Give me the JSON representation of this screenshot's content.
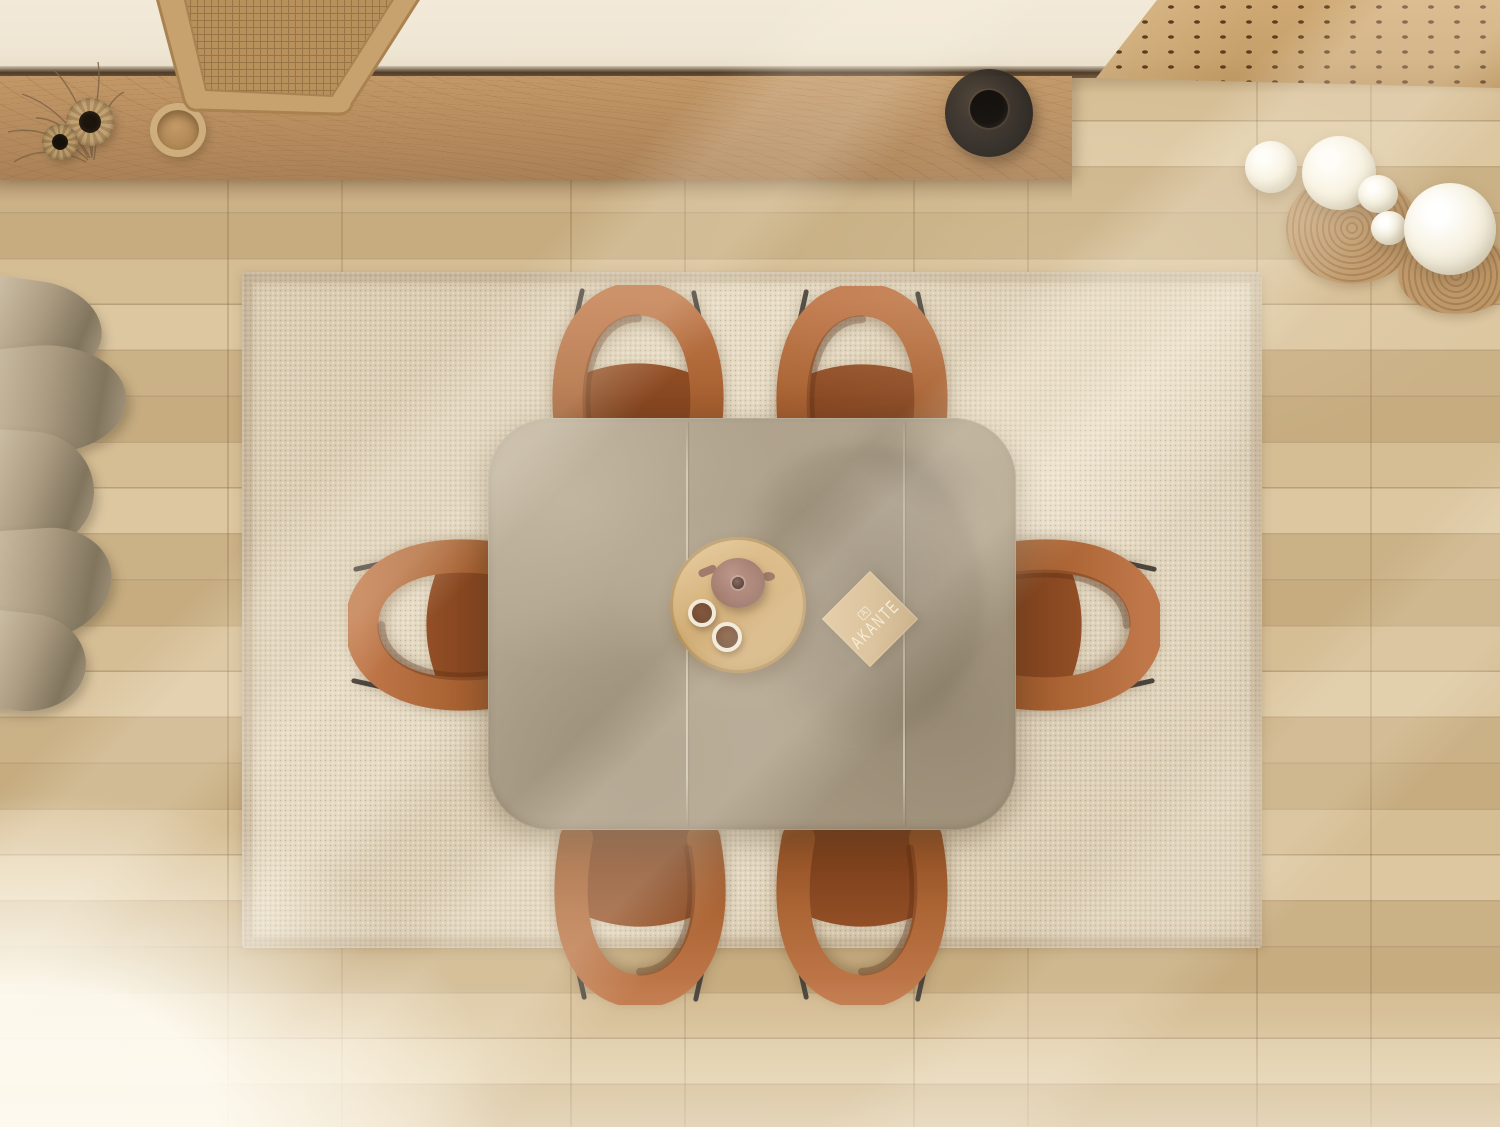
{
  "meta": {
    "description": "Top-down view of a dining room: ceramic-top extendable dining table with six rust velvet chairs on a beige woven rug over light oak flooring; wooden sideboard with vases and rattan tray at top; dark sphere vase; white globe pendant lights over wooden discs; curtain pooling at left; sunlight streaks across the floor.",
    "brand_visible": "AKANTE"
  },
  "book": {
    "logo_mark": "A",
    "brand_text": "AKANTE"
  },
  "objects": [
    "dining-table",
    "dining-chair x6",
    "area-rug",
    "round-serving-tray",
    "teapot",
    "coffee-cup x2",
    "brand-catalog",
    "sideboard",
    "rattan-tray",
    "woven-vase x2",
    "wooden-bowl",
    "dark-sphere-vase",
    "globe-pendant-lights",
    "wood-slice-discs",
    "curtain",
    "slatted-bench",
    "oak-floor"
  ],
  "colors": {
    "wall": "#efe6d4",
    "groove": "#4e3b28",
    "sideboard": "#b88e60",
    "floor_a": "#d5bd94",
    "floor_b": "#cbb186",
    "floor_c": "#dcc7a1",
    "floor_d": "#c6ac7f",
    "rug_base": "#dbcdb3",
    "table_base": "#a59780",
    "chair_band": "#b06a38",
    "chair_band_dark": "#8f4f24",
    "chair_seat": "#8a4921",
    "chair_seat_dark": "#6f3716",
    "leg": "#4a443c",
    "tray": "#d0ab72",
    "teapot": "#a57d70",
    "coffee": "#6f4a33",
    "cup_rim": "#f1e9d8",
    "book_bg": "#cfb184",
    "book_text": "#f6eedb",
    "vase_dark": "#2b2520",
    "bulb": "#f7f2e3",
    "bulb_shade": "#d6cfba",
    "wood_disc": "#bd9464",
    "disc_ring": "#a37c50",
    "curtain_hi": "#d2c5ab",
    "curtain_mid": "#ac9c82",
    "curtain_dark": "#81755e",
    "bench": "#c6a06a",
    "slot": "#5e3d1f",
    "twig": "#7c6448",
    "sun": "#fffaec"
  }
}
